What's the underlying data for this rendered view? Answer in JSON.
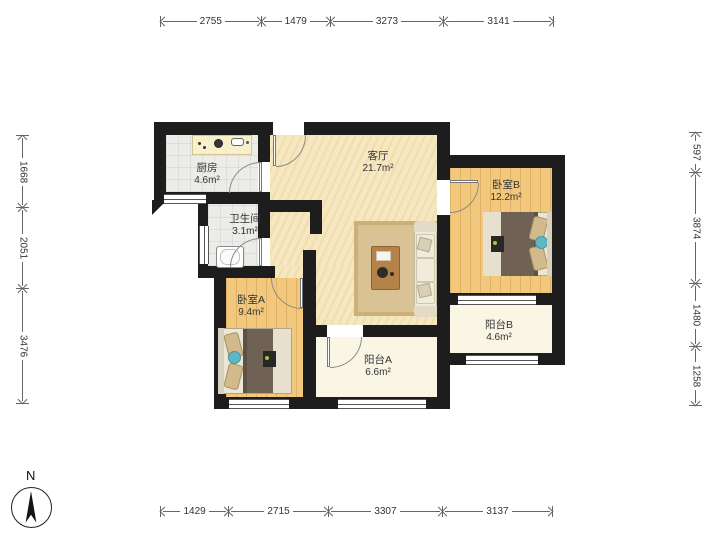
{
  "rooms": [
    {
      "name": "厨房",
      "area": "4.6m²"
    },
    {
      "name": "卫生间",
      "area": "3.1m²"
    },
    {
      "name": "客厅",
      "area": "21.7m²"
    },
    {
      "name": "卧室B",
      "area": "12.2m²"
    },
    {
      "name": "卧室A",
      "area": "9.4m²"
    },
    {
      "name": "阳台A",
      "area": "6.6m²"
    },
    {
      "name": "阳台B",
      "area": "4.6m²"
    }
  ],
  "dimensions": {
    "top": [
      "2755",
      "1479",
      "3273",
      "3141"
    ],
    "bottom": [
      "1429",
      "2715",
      "3307",
      "3137"
    ],
    "left": [
      "1668",
      "2051",
      "3476"
    ],
    "right": [
      "597",
      "3874",
      "1480",
      "1258"
    ]
  },
  "compass": {
    "label": "N"
  },
  "colors": {
    "wall": "#1d1d1d",
    "wood_floor": "#f2c87d",
    "living_floor": "#f5e7c0",
    "balcony_floor": "#faf6e6",
    "tile_floor": "#ececе8",
    "rug": "#d9c395",
    "bed_blanket": "#6f6254",
    "accent_teal": "#5fb7c6",
    "counter": "#f7f0cd"
  }
}
